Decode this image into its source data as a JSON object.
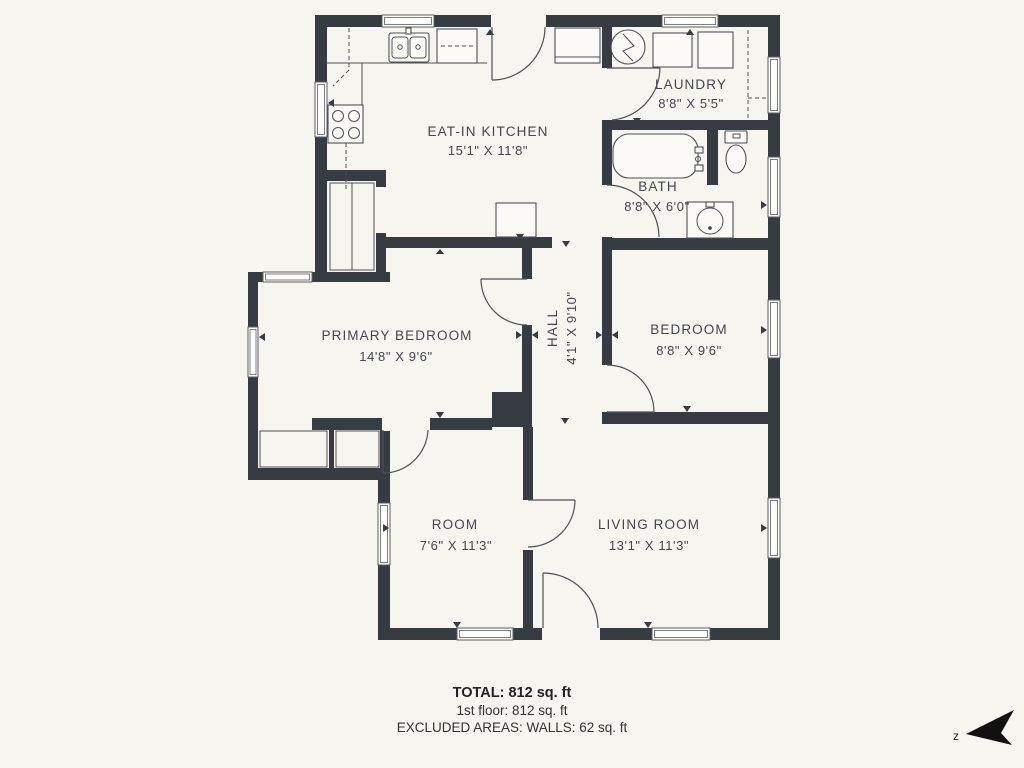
{
  "page": {
    "background": "#f7f5f0",
    "wall_color": "#373c42",
    "line_color": "#4d5156",
    "window_stroke": "#5a5e63",
    "text_color": "#43474d",
    "footer_text_color": "#222222"
  },
  "rooms": [
    {
      "id": "eat-in-kitchen",
      "name": "EAT-IN KITCHEN",
      "dims": "15'1\" X 11'8\""
    },
    {
      "id": "laundry",
      "name": "LAUNDRY",
      "dims": "8'8\" X 5'5\""
    },
    {
      "id": "bath",
      "name": "BATH",
      "dims": "8'8\" X 6'0\""
    },
    {
      "id": "primary-bedroom",
      "name": "PRIMARY BEDROOM",
      "dims": "14'8\" X 9'6\""
    },
    {
      "id": "hall",
      "name": "HALL",
      "dims": "4'1\" X 9'10\""
    },
    {
      "id": "bedroom",
      "name": "BEDROOM",
      "dims": "8'8\" X 9'6\""
    },
    {
      "id": "room",
      "name": "ROOM",
      "dims": "7'6\" X 11'3\""
    },
    {
      "id": "living-room",
      "name": "LIVING ROOM",
      "dims": "13'1\" X 11'3\""
    }
  ],
  "summary": {
    "total": "TOTAL: 812 sq. ft",
    "first_floor": "1st floor: 812 sq. ft",
    "excluded": "EXCLUDED AREAS: WALLS: 62 sq. ft"
  },
  "compass": {
    "letter": "z"
  }
}
